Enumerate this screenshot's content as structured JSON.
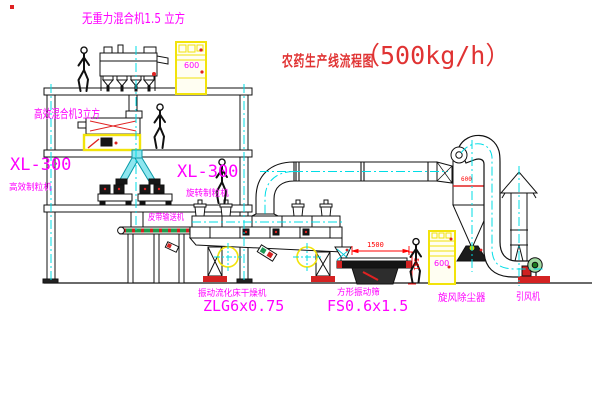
{
  "title": {
    "text": "农药生产线流程图",
    "capacity": "（500kg/h）"
  },
  "equipment_labels": {
    "gravity_mixer": "无重力混合机1.5 立方",
    "high_eff_mixer": "高效混合机3立方",
    "granulator_left": {
      "model": "XL-300",
      "name": "高效制粒机"
    },
    "granulator_center": {
      "model": "XL-300",
      "name": "旋转制粒机"
    },
    "belt_conveyor": "皮带输送机",
    "fluid_bed_dryer": {
      "name": "振动流化床干燥机",
      "model": "ZLG6x0.75"
    },
    "vibrating_sieve": {
      "name": "方形振动筛",
      "model": "FS0.6x1.5"
    },
    "cyclone_dust_collector": "旋风除尘器",
    "induced_draft_fan": "引风机"
  },
  "dimensions": {
    "sieve_length": "1500",
    "sieve_height": "541",
    "cyclone_marking": "600"
  },
  "cabinets": {
    "cabinet1_mark": "600",
    "cabinet2_mark": "600"
  },
  "colors": {
    "label": "#ff00ff",
    "title": "#e03333",
    "centerline": "#00dde6",
    "highlight": "#f2e30a",
    "accent": "#ff0000",
    "line": "#111111"
  }
}
